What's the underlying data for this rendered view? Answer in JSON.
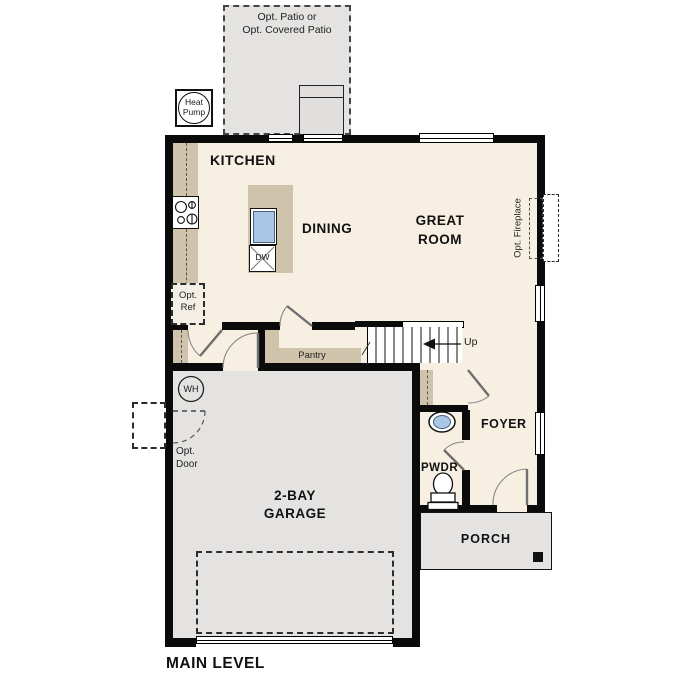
{
  "title": "MAIN LEVEL",
  "colors": {
    "floor": "#f6efe2",
    "hardscape": "#e4e3e1",
    "counter": "#cfc3ab",
    "sink": "#a9c7e5",
    "wall": "#0b0b0b"
  },
  "labels": {
    "patio": "Opt. Patio or\nOpt. Covered Patio",
    "heat_pump": "Heat\nPump",
    "kitchen": "KITCHEN",
    "dining": "DINING",
    "great_room": "GREAT\nROOM",
    "dishwasher": "DW",
    "opt_ref": "Opt.\nRef",
    "pantry": "Pantry",
    "up": "Up",
    "opt_fireplace": "Opt. Fireplace",
    "water_heater": "WH",
    "opt_door": "Opt.\nDoor",
    "garage": "2-BAY\nGARAGE",
    "foyer": "FOYER",
    "pwdr": "PWDR",
    "porch": "PORCH",
    "main_level": "MAIN LEVEL"
  }
}
